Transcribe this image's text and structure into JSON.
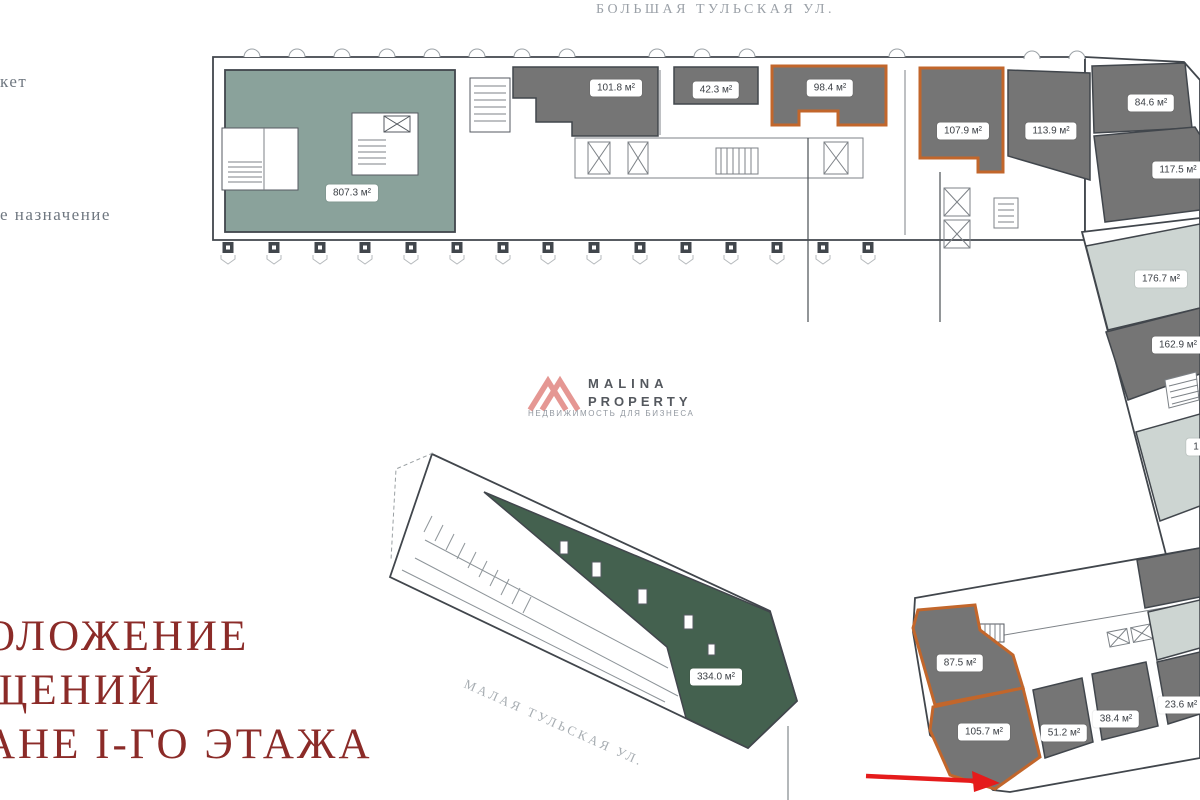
{
  "streets": {
    "top": "БОЛЬШАЯ ТУЛЬСКАЯ УЛ.",
    "diagonal": "МАЛАЯ ТУЛЬСКАЯ УЛ."
  },
  "legend": {
    "item_top": "кет",
    "item_bottom": "е назначение"
  },
  "title": {
    "line1": "ОЛОЖЕНИЕ",
    "line2": "ЩЕНИЙ",
    "line3": "АНЕ I-ГО ЭТАЖА"
  },
  "logo": {
    "line1": "MALINA",
    "line2": "PROPERTY",
    "tagline": "НЕДВИЖИМОСТЬ ДЛЯ БИЗНЕСА"
  },
  "units": {
    "u807": "807.3 м²",
    "u101": "101.8 м²",
    "u42": "42.3 м²",
    "u98": "98.4 м²",
    "u107": "107.9 м²",
    "u113": "113.9 м²",
    "u84": "84.6 м²",
    "u117": "117.5 м²",
    "u176": "176.7 м²",
    "u162": "162.9 м²",
    "u_cut": "1",
    "u334": "334.0 м²",
    "u87": "87.5 м²",
    "u105": "105.7 м²",
    "u51": "51.2 м²",
    "u38": "38.4 м²",
    "u23": "23.6 м²"
  },
  "colors": {
    "unit_dark_gray": "#757575",
    "unit_light_gray": "#cdd5d2",
    "supermarket_green": "#8aa29b",
    "building_green": "#44614f",
    "highlight_orange": "#c2662b",
    "title_red": "#8b2b28",
    "arrow_red": "#e51b1b",
    "logo_salmon": "#e59793",
    "street_gray": "#9ba1a8",
    "wall_dark": "#41464c"
  }
}
